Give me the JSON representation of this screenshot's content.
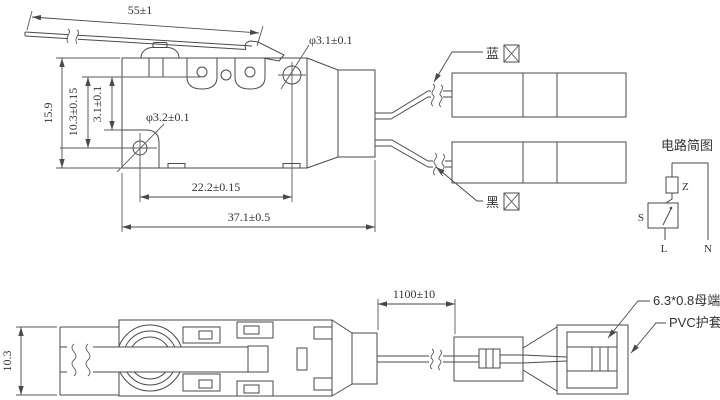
{
  "style": {
    "line_color": "#4a4a4a",
    "background": "#ffffff",
    "text_color": "#333333"
  },
  "top": {
    "dim_lever": "55±1",
    "dim_hole_top": "φ3.1±0.1",
    "dim_hole_bottom": "φ3.2±0.1",
    "dim_height": "15.9",
    "dim_hole_height": "10.3±0.15",
    "dim_small": "3.1±0.1",
    "dim_hole_spacing": "22.2±0.15",
    "dim_body": "37.1±0.5",
    "label_blue": "蓝",
    "label_black": "黑"
  },
  "circuit": {
    "title": "电路简图",
    "z": "Z",
    "s": "S",
    "l": "L",
    "n": "N"
  },
  "bottom": {
    "dim_width": "10.3",
    "dim_wire": "1100±10",
    "label_terminal": "6.3*0.8母端",
    "label_sheath": "PVC护套"
  }
}
